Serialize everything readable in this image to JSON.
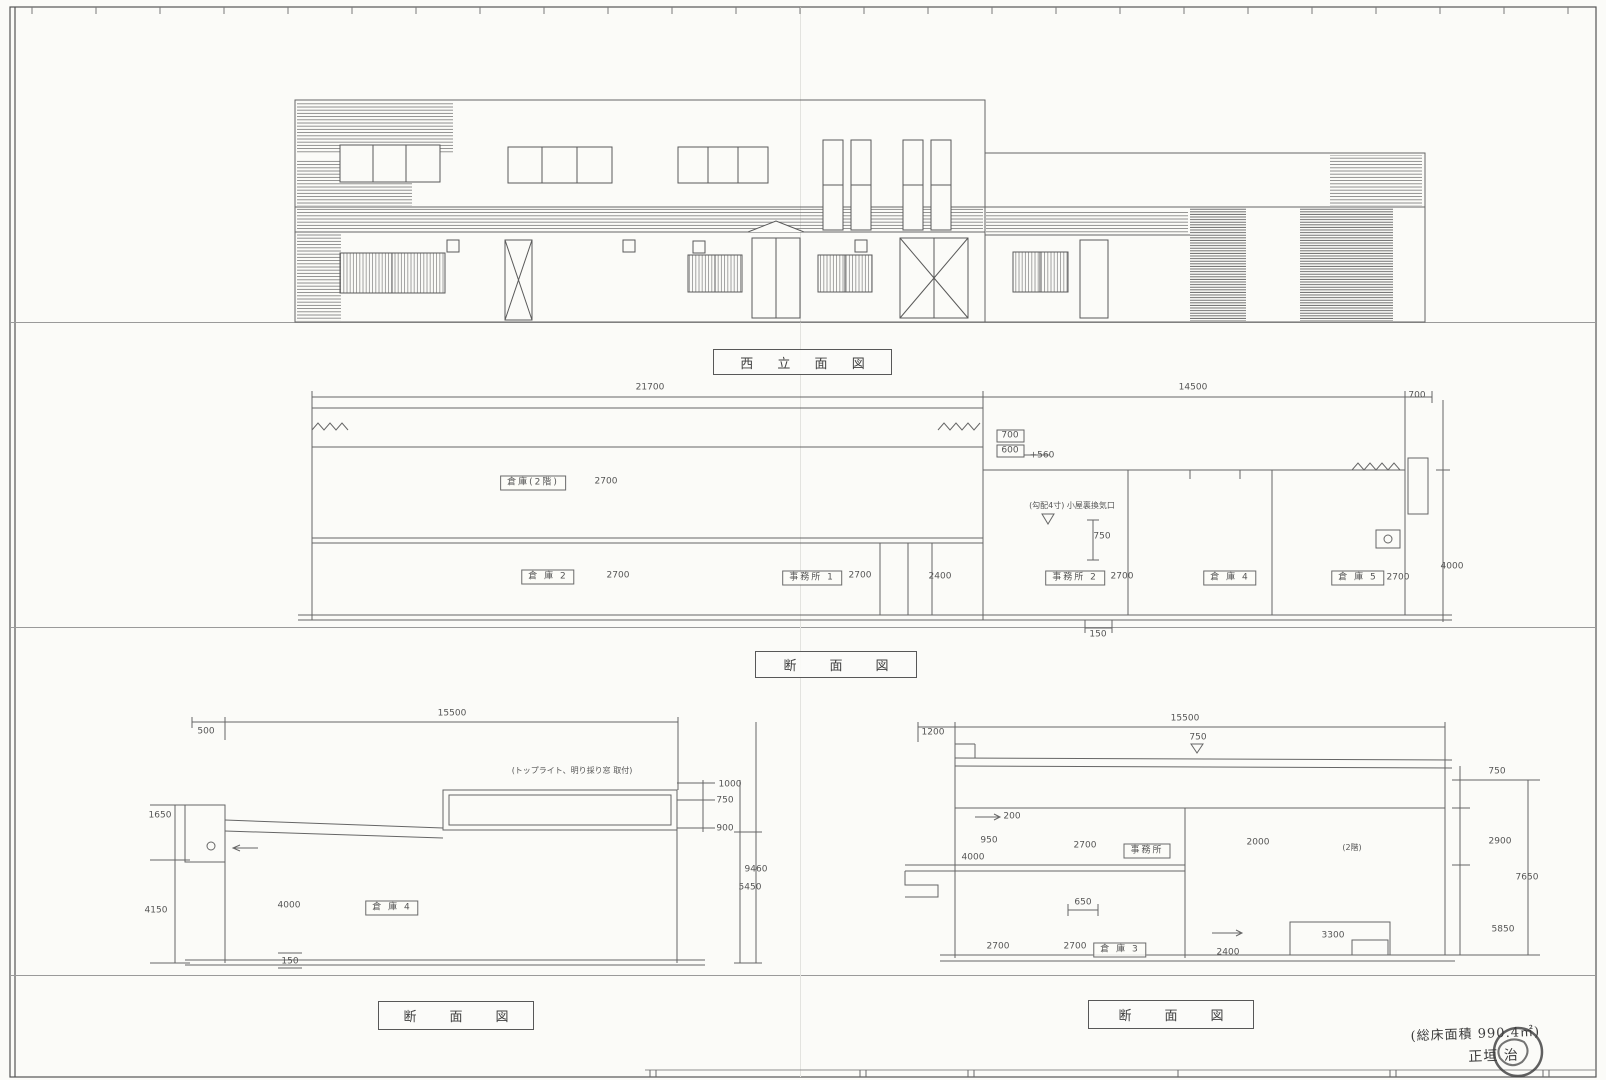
{
  "sheet": {
    "background": "#fbfbf8",
    "line_color": "#6a6a6a",
    "titles": [
      {
        "id": "elevation-title",
        "label": "西 立 面 図"
      },
      {
        "id": "section-main-title",
        "label": "断　面　図"
      },
      {
        "id": "section-left-title",
        "label": "断　面　図"
      },
      {
        "id": "section-right-title",
        "label": "断　面　図"
      }
    ],
    "handwriting": {
      "line1": "(総床面積 990.4㎡)",
      "line2": "正垣 治"
    }
  },
  "annotations": [
    {
      "group": "section-main",
      "items": [
        {
          "t": "21700",
          "x": 650,
          "y": 388
        },
        {
          "t": "14500",
          "x": 1193,
          "y": 388
        },
        {
          "t": "700",
          "x": 1417,
          "y": 396
        },
        {
          "t": "700",
          "x": 1010,
          "y": 436
        },
        {
          "t": "600",
          "x": 1010,
          "y": 451
        },
        {
          "t": "+560",
          "x": 1042,
          "y": 456
        },
        {
          "t": "倉庫(2階)",
          "x": 533,
          "y": 483,
          "boxed": true
        },
        {
          "t": "2700",
          "x": 606,
          "y": 482
        },
        {
          "t": "(勾配4寸) 小屋裏換気口",
          "x": 1072,
          "y": 506,
          "size": 8
        },
        {
          "t": "750",
          "x": 1102,
          "y": 537
        },
        {
          "t": "倉 庫 2",
          "x": 548,
          "y": 577,
          "boxed": true
        },
        {
          "t": "2700",
          "x": 618,
          "y": 576
        },
        {
          "t": "事務所 1",
          "x": 812,
          "y": 578,
          "boxed": true
        },
        {
          "t": "2700",
          "x": 860,
          "y": 576
        },
        {
          "t": "2400",
          "x": 940,
          "y": 577
        },
        {
          "t": "事務所 2",
          "x": 1075,
          "y": 578,
          "boxed": true
        },
        {
          "t": "2700",
          "x": 1122,
          "y": 577
        },
        {
          "t": "倉 庫 4",
          "x": 1230,
          "y": 578,
          "boxed": true
        },
        {
          "t": "倉 庫 5",
          "x": 1358,
          "y": 578,
          "boxed": true
        },
        {
          "t": "2700",
          "x": 1398,
          "y": 578
        },
        {
          "t": "4000",
          "x": 1452,
          "y": 567
        },
        {
          "t": "150",
          "x": 1098,
          "y": 635
        }
      ]
    },
    {
      "group": "section-left",
      "items": [
        {
          "t": "15500",
          "x": 452,
          "y": 714
        },
        {
          "t": "500",
          "x": 206,
          "y": 732
        },
        {
          "t": "(トップライト、明り採り窓 取付)",
          "x": 572,
          "y": 771,
          "size": 8
        },
        {
          "t": "1000",
          "x": 730,
          "y": 785
        },
        {
          "t": "750",
          "x": 725,
          "y": 801
        },
        {
          "t": "900",
          "x": 725,
          "y": 829
        },
        {
          "t": "9460",
          "x": 756,
          "y": 870
        },
        {
          "t": "5450",
          "x": 750,
          "y": 888
        },
        {
          "t": "1650",
          "x": 160,
          "y": 816
        },
        {
          "t": "4150",
          "x": 156,
          "y": 911
        },
        {
          "t": "4000",
          "x": 289,
          "y": 906
        },
        {
          "t": "倉 庫 4",
          "x": 392,
          "y": 908,
          "boxed": true
        },
        {
          "t": "150",
          "x": 290,
          "y": 962
        }
      ]
    },
    {
      "group": "section-right",
      "items": [
        {
          "t": "15500",
          "x": 1185,
          "y": 719
        },
        {
          "t": "1200",
          "x": 933,
          "y": 733
        },
        {
          "t": "750",
          "x": 1198,
          "y": 738
        },
        {
          "t": "750",
          "x": 1497,
          "y": 772
        },
        {
          "t": "200",
          "x": 1012,
          "y": 817
        },
        {
          "t": "950",
          "x": 989,
          "y": 841
        },
        {
          "t": "2700",
          "x": 1085,
          "y": 846
        },
        {
          "t": "事務所",
          "x": 1147,
          "y": 851,
          "boxed": true
        },
        {
          "t": "2000",
          "x": 1258,
          "y": 843
        },
        {
          "t": "(2階)",
          "x": 1352,
          "y": 848,
          "size": 8
        },
        {
          "t": "4000",
          "x": 973,
          "y": 858
        },
        {
          "t": "650",
          "x": 1083,
          "y": 903
        },
        {
          "t": "2700",
          "x": 998,
          "y": 947
        },
        {
          "t": "2700",
          "x": 1075,
          "y": 947
        },
        {
          "t": "倉 庫 3",
          "x": 1120,
          "y": 950,
          "boxed": true
        },
        {
          "t": "2400",
          "x": 1228,
          "y": 953
        },
        {
          "t": "3300",
          "x": 1333,
          "y": 936
        },
        {
          "t": "2900",
          "x": 1500,
          "y": 842
        },
        {
          "t": "7650",
          "x": 1527,
          "y": 878
        },
        {
          "t": "5850",
          "x": 1503,
          "y": 930
        }
      ]
    }
  ]
}
